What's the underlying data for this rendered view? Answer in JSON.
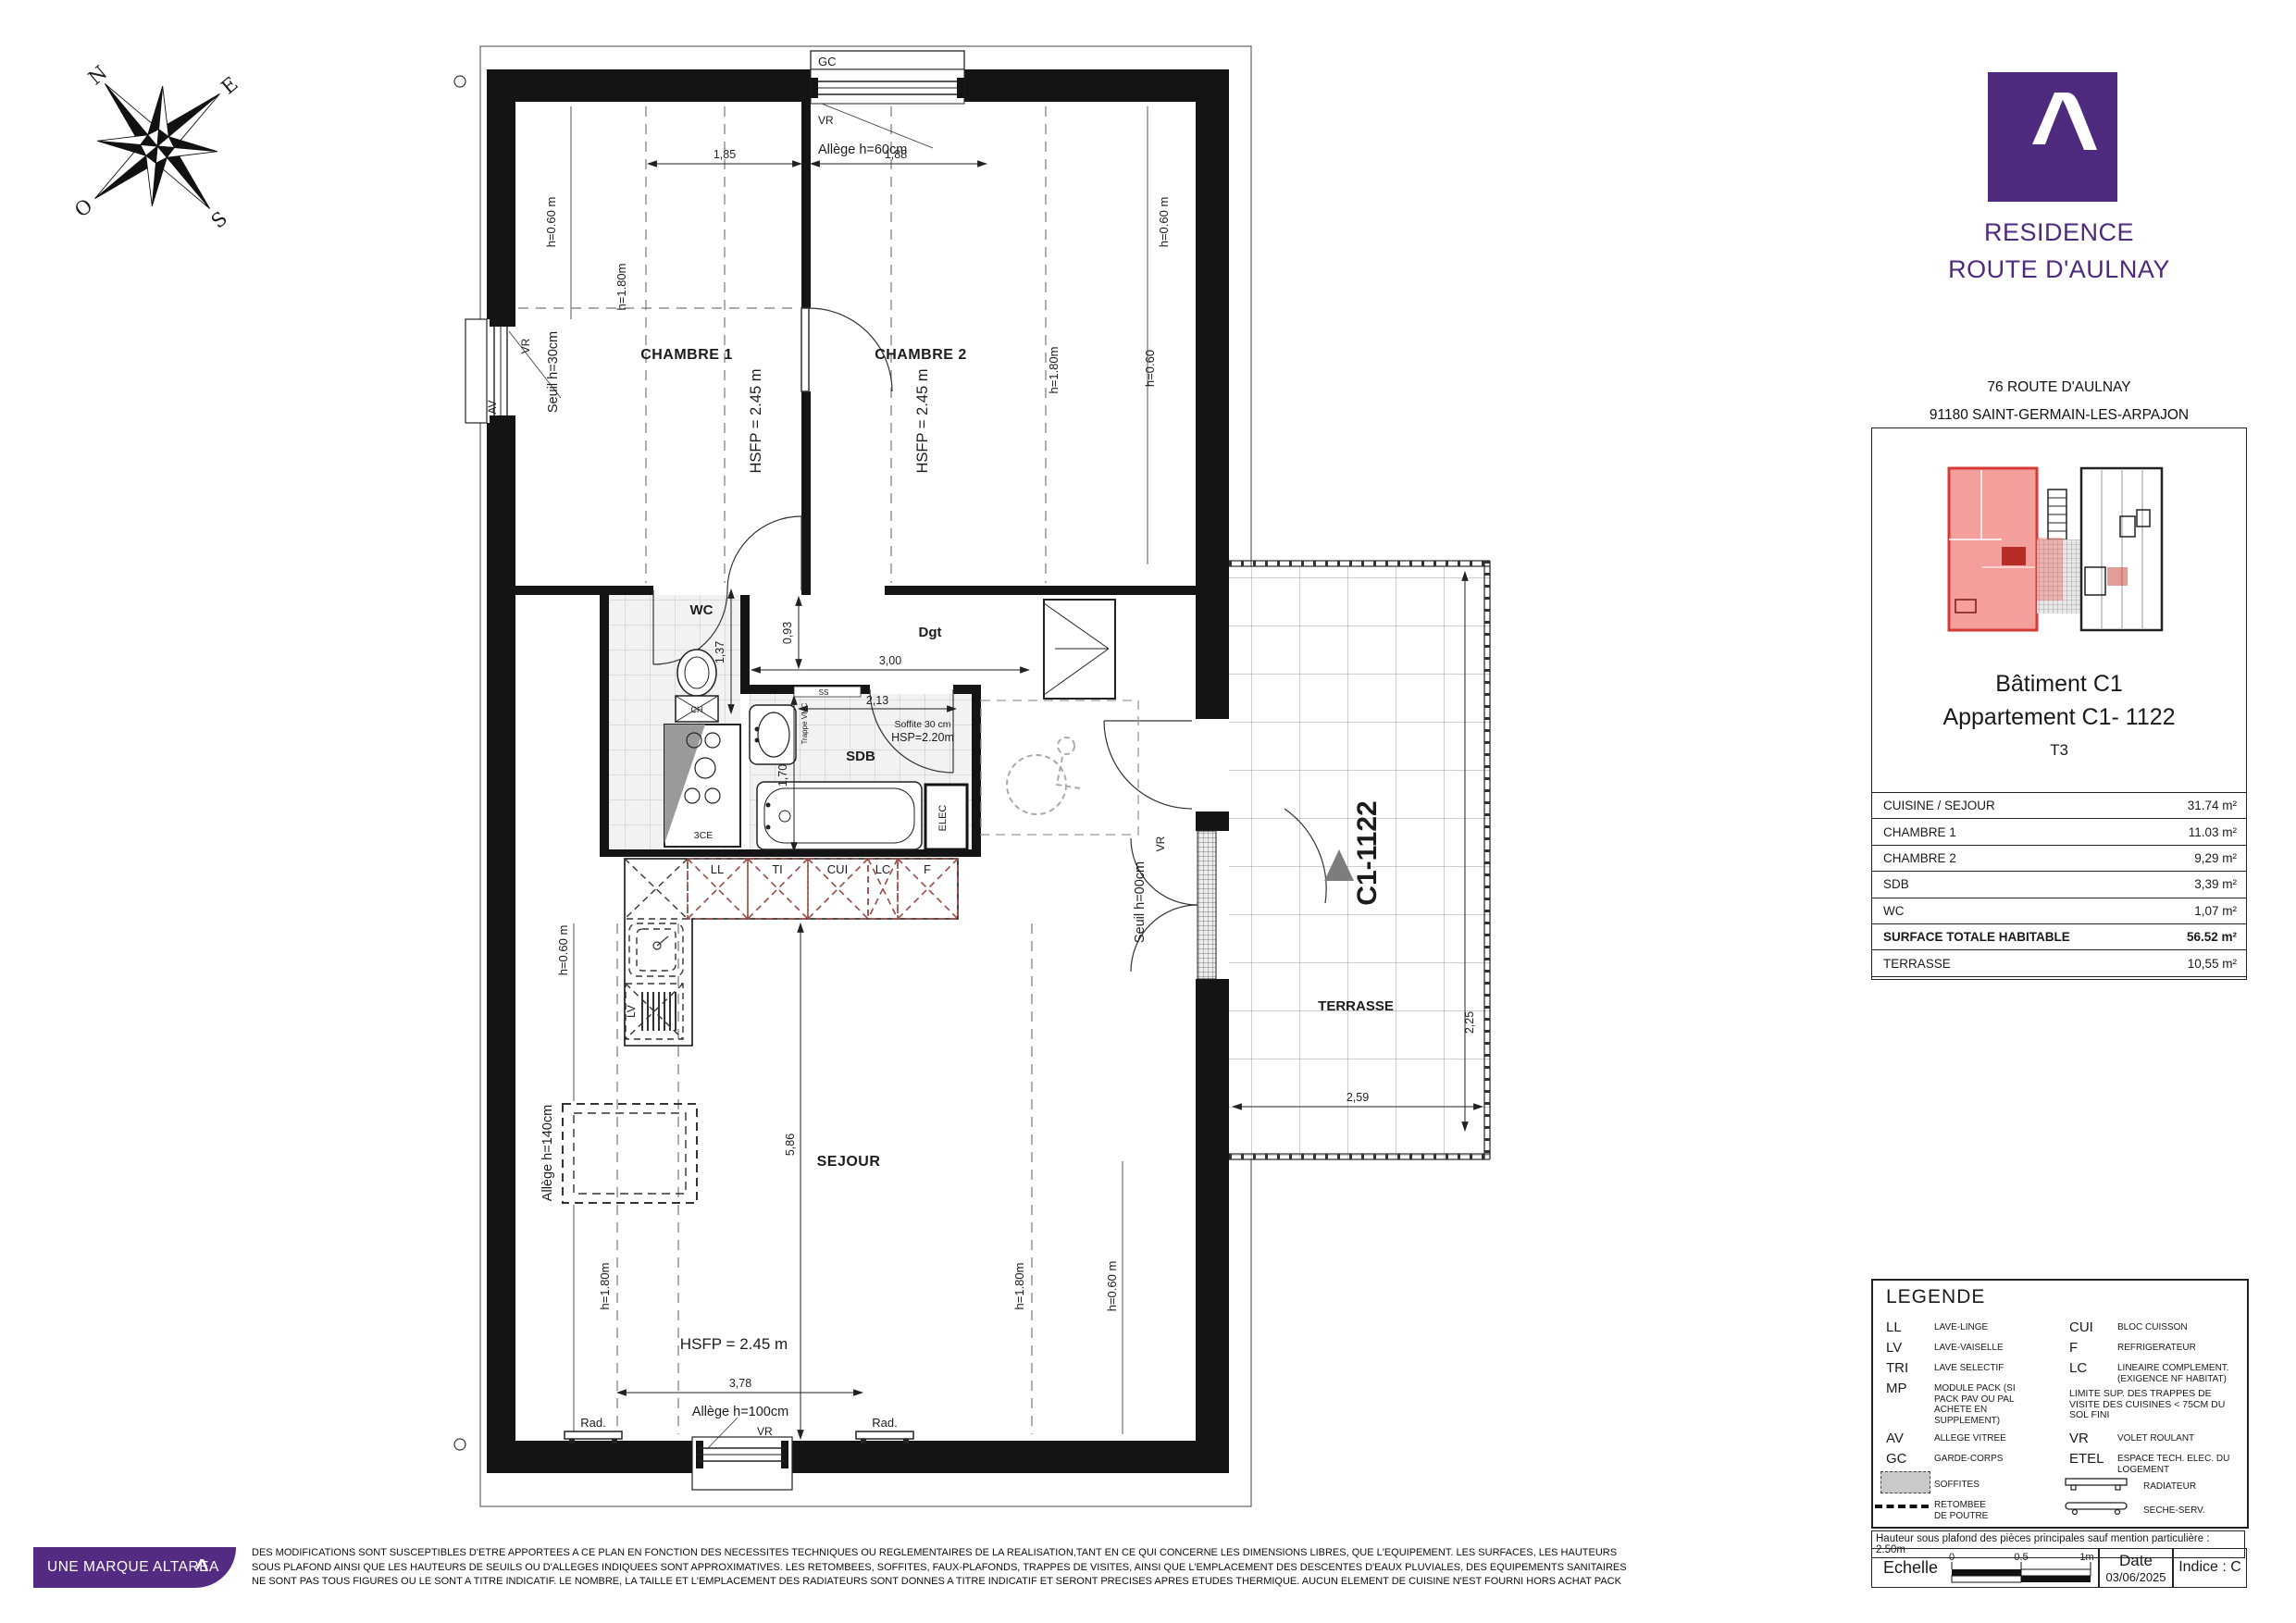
{
  "plan": {
    "compass": {
      "n": "N",
      "e": "E",
      "s": "S",
      "o": "O"
    },
    "rooms": {
      "chambre1": "CHAMBRE 1",
      "chambre2": "CHAMBRE 2",
      "wc": "WC",
      "sdb": "SDB",
      "dgt": "Dgt",
      "sejour": "SEJOUR",
      "terrasse": "TERRASSE",
      "elec": "ELEC"
    },
    "fixtures": {
      "shower": "3CE",
      "ch": "CH",
      "lv": "LV",
      "rad": "Rad."
    },
    "kitchen": {
      "ll": "LL",
      "ti": "TI",
      "cui": "CUI",
      "lc": "LC",
      "f": "F"
    },
    "heights": {
      "hsfp": "HSFP = 2.45 m",
      "h060m": "h=0.60 m",
      "h060": "h=0.60",
      "h180": "h=1.80m",
      "hsp": "HSP=2.20m",
      "soffite": "Soffite 30 cm",
      "ss": "SS",
      "trappe": "Trappe VMC"
    },
    "openings": {
      "gc": "GC",
      "vr": "VR",
      "av": "AV",
      "allege60": "Allège h=60cm",
      "allege100": "Allège h=100cm",
      "allege140": "Allège h=140cm",
      "seuil30": "Seuil h=30cm",
      "seuil00": "Seuil h=00cm"
    },
    "dims": {
      "d185": "1,85",
      "d188": "1,88",
      "d093": "0,93",
      "d137": "1,37",
      "d300": "3,00",
      "d213": "2,13",
      "d170": "1,70",
      "d378": "3,78",
      "d586": "5,86",
      "d259": "2,59",
      "d225": "2,25"
    },
    "marker": "C1-1122"
  },
  "panel": {
    "brand": {
      "line1": "RESIDENCE",
      "line2": "ROUTE D'AULNAY"
    },
    "address": {
      "line1": "76 ROUTE D'AULNAY",
      "line2": "91180 SAINT-GERMAIN-LES-ARPAJON"
    },
    "unit": {
      "building": "Bâtiment C1",
      "apartment": "Appartement C1- 1122",
      "type": "T3"
    },
    "table": {
      "rows": [
        {
          "label": "CUISINE / SEJOUR",
          "value": "31.74 m²"
        },
        {
          "label": "CHAMBRE 1",
          "value": "11.03 m²"
        },
        {
          "label": "CHAMBRE 2",
          "value": "9,29 m²"
        },
        {
          "label": "SDB",
          "value": "3,39 m²"
        },
        {
          "label": "WC",
          "value": "1,07 m²"
        }
      ],
      "total": {
        "label": "SURFACE TOTALE HABITABLE",
        "value": "56.52 m²"
      },
      "terrasse": {
        "label": "TERRASSE",
        "value": "10,55 m²"
      }
    }
  },
  "legend": {
    "title": "LEGENDE",
    "items_left": [
      {
        "abbr": "LL",
        "desc": "LAVE-LINGE"
      },
      {
        "abbr": "LV",
        "desc": "LAVE-VAISELLE"
      },
      {
        "abbr": "TRI",
        "desc": "LAVE SELECTIF"
      },
      {
        "abbr": "MP",
        "desc": "MODULE PACK (SI PACK PAV OU PAL ACHETE EN SUPPLEMENT)"
      },
      {
        "abbr": "AV",
        "desc": "ALLEGE VITREE"
      },
      {
        "abbr": "GC",
        "desc": "GARDE-CORPS"
      }
    ],
    "soffites": "SOFFITES",
    "retombee": "RETOMBEE DE POUTRE",
    "items_right": [
      {
        "abbr": "CUI",
        "desc": "BLOC CUISSON"
      },
      {
        "abbr": "F",
        "desc": "REFRIGERATEUR"
      },
      {
        "abbr": "LC",
        "desc": "LINEAIRE COMPLEMENT. (EXIGENCE NF HABITAT)"
      }
    ],
    "note": "LIMITE SUP. DES TRAPPES DE VISITE DES CUISINES < 75CM DU SOL FINI",
    "vr": {
      "abbr": "VR",
      "desc": "VOLET ROULANT"
    },
    "etel": {
      "abbr": "ETEL",
      "desc": "ESPACE TECH. ELEC. DU LOGEMENT"
    },
    "radiateur": "RADIATEUR",
    "seche": "SECHE-SERV.",
    "ceiling_note": "Hauteur sous plafond des pièces principales sauf mention particulière : 2.50m"
  },
  "titleblock": {
    "echelle": "Echelle",
    "scale0": "0",
    "scale05": "0.5",
    "scale1": "1m",
    "date_label": "Date",
    "date_value": "03/06/2025",
    "indice": "Indice : C"
  },
  "footer": {
    "brand": "UNE MARQUE ALTAREA",
    "disclaimer1": "DES MODIFICATIONS SONT SUSCEPTIBLES D'ETRE APPORTEES A CE PLAN EN FONCTION DES NECESSITES TECHNIQUES OU REGLEMENTAIRES DE LA REALISATION,TANT EN CE QUI CONCERNE LES DIMENSIONS LIBRES, QUE L'EQUIPEMENT. LES SURFACES, LES HAUTEURS",
    "disclaimer2": "SOUS PLAFOND AINSI QUE LES HAUTEURS DE SEUILS OU D'ALLEGES INDIQUEES SONT APPROXIMATIVES. LES RETOMBEES, SOFFITES, FAUX-PLAFONDS, TRAPPES DE VISITES, AINSI QUE L'EMPLACEMENT DES DESCENTES D'EAUX PLUVIALES, DES EQUIPEMENTS SANITAIRES",
    "disclaimer3": "NE SONT PAS TOUS FIGURES OU LE SONT A TITRE INDICATIF. LE NOMBRE, LA TAILLE ET L'EMPLACEMENT DES RADIATEURS SONT DONNES A TITRE INDICATIF ET SERONT PRECISES APRES ETUDES THERMIQUE. AUCUN ELEMENT DE CUISINE N'EST FOURNI HORS ACHAT PACK"
  },
  "colors": {
    "purple": "#4e2a7e",
    "kitchen_red": "#9a4a42",
    "key_red": "#d63a34"
  }
}
